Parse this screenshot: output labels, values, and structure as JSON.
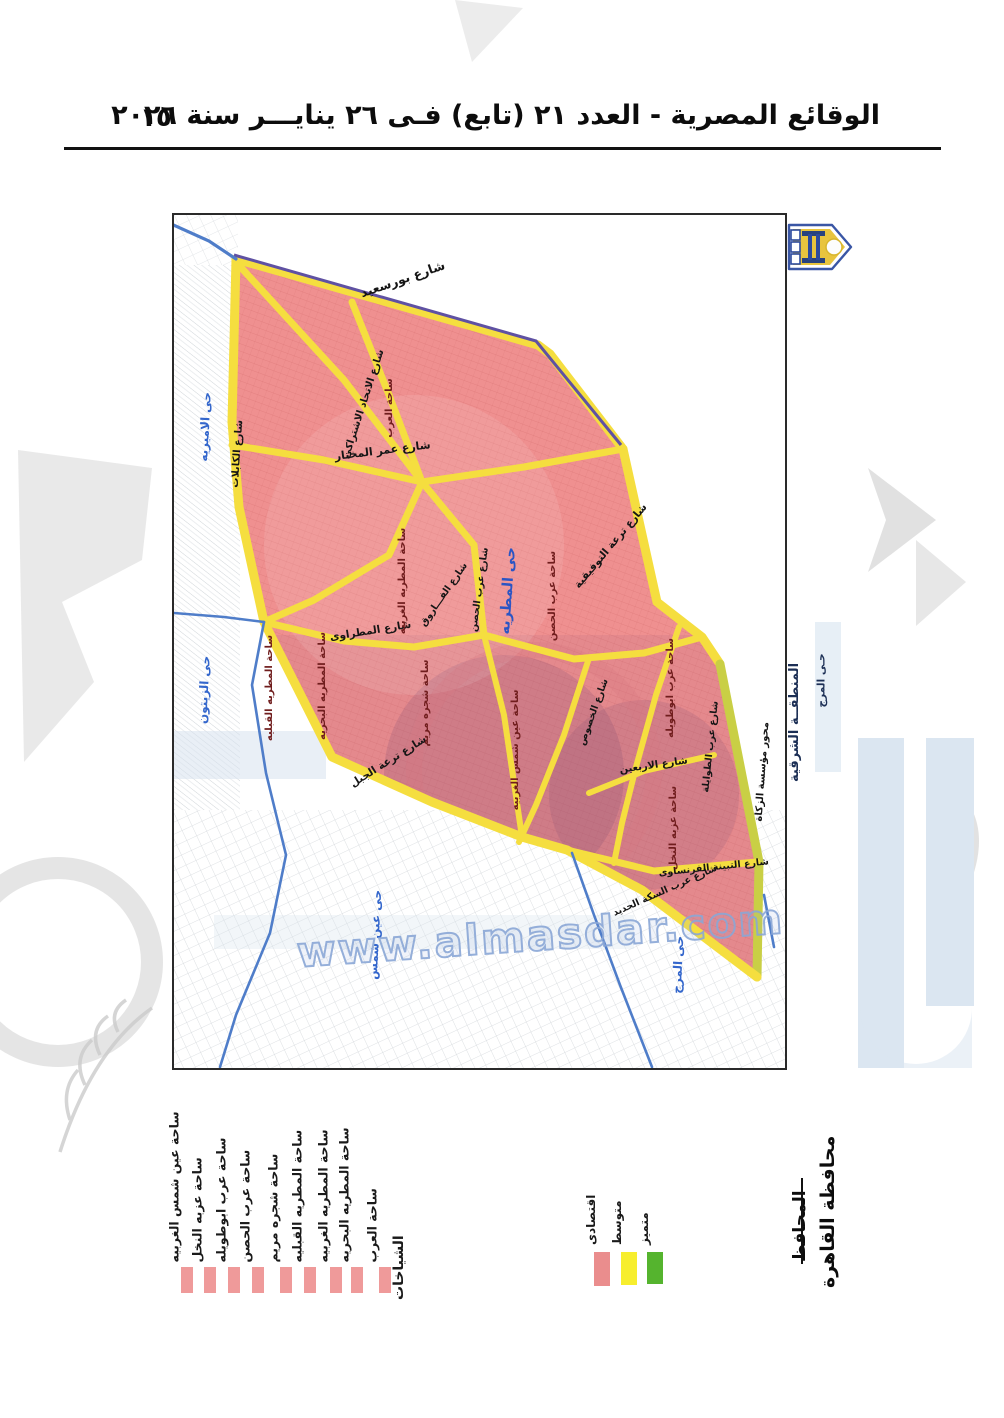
{
  "header": {
    "title": "الوقائع المصرية - العدد ٢١ (تابع) فـى ٢٦ ينايـــر سنة ٢٠٢٦",
    "page_number": "١٥"
  },
  "map": {
    "watermark": "www.almasdar.com",
    "district_label": "حى المطريه",
    "outside_zone": {
      "line1": "المنطقــة الشرقية",
      "line2": "حـى المرج"
    },
    "streets": [
      {
        "label": "شارع بورسعيد"
      },
      {
        "label": "شارع الاتحاد الاشتراكى"
      },
      {
        "label": "شارع عمر المختار"
      },
      {
        "label": "شارع الكابلات"
      },
      {
        "label": "شارع ترعة التوفيقية"
      },
      {
        "label": "شارع عرب الحصن"
      },
      {
        "label": "شارع الفـــاروق"
      },
      {
        "label": "شارع المطراوى"
      },
      {
        "label": "شارع الخصوص"
      },
      {
        "label": "شارع الاربعين"
      },
      {
        "label": "شارع عرب الطوايلة"
      },
      {
        "label": "شارع ترعة الجبل"
      },
      {
        "label": "محور مؤسسة الزكاة"
      },
      {
        "label": "شارع التبينة الفرنساوى"
      },
      {
        "label": "شارع عرب السكة الحديد"
      }
    ],
    "squares": [
      {
        "label": "ساحة العرب"
      },
      {
        "label": "ساحة عرب الحصن"
      },
      {
        "label": "ساحة المطريه الغربيه"
      },
      {
        "label": "ساحة المطريه البحريه"
      },
      {
        "label": "ساحة المطريه القبليه"
      },
      {
        "label": "ساحة شجره مريم"
      },
      {
        "label": "ساحة عين شمس الغربيه"
      },
      {
        "label": "ساحة عرب ابوطويله"
      },
      {
        "label": "ساحة عزبه النخل"
      }
    ],
    "neighbors": [
      {
        "label": "حى الاميريه"
      },
      {
        "label": "حى الزيتون"
      },
      {
        "label": "حى عين شمس"
      },
      {
        "label": "حى المرج"
      }
    ]
  },
  "legend": {
    "squares_title": "الشياخات",
    "square_items": [
      {
        "label": "ساحة العرب"
      },
      {
        "label": "ساحة المطريه البحريه"
      },
      {
        "label": "ساحة المطريه الغربيه"
      },
      {
        "label": "ساحة المطريه القبليه"
      },
      {
        "label": "ساحة شجره مريم"
      },
      {
        "label": "ساحة عرب الحصن"
      },
      {
        "label": "ساحة عرب ابوطويله"
      },
      {
        "label": "ساحة عزبه النخل"
      },
      {
        "label": "ساحة عين شمس الغربيه"
      }
    ],
    "quality_items": [
      {
        "label": "متميز",
        "color": "#55b42e"
      },
      {
        "label": "متوسط",
        "color": "#f7ee2e"
      },
      {
        "label": "اقتصادى",
        "color": "#ea8d8d"
      }
    ],
    "square_swatch_color": "#ef9a9a"
  },
  "signature": {
    "governorate": "محافظة القاهرة",
    "governor": "المحافظ"
  },
  "colors": {
    "district_fill": "#ef9090",
    "road_yellow": "#f5de3f",
    "canal_blue": "#4f7dc9",
    "boundary_purple": "#5f51a3",
    "axis_olive": "#c9cf45",
    "square_label": "#701d1d",
    "district_label": "#2b55c4",
    "neighbor_label": "#3366cc"
  }
}
